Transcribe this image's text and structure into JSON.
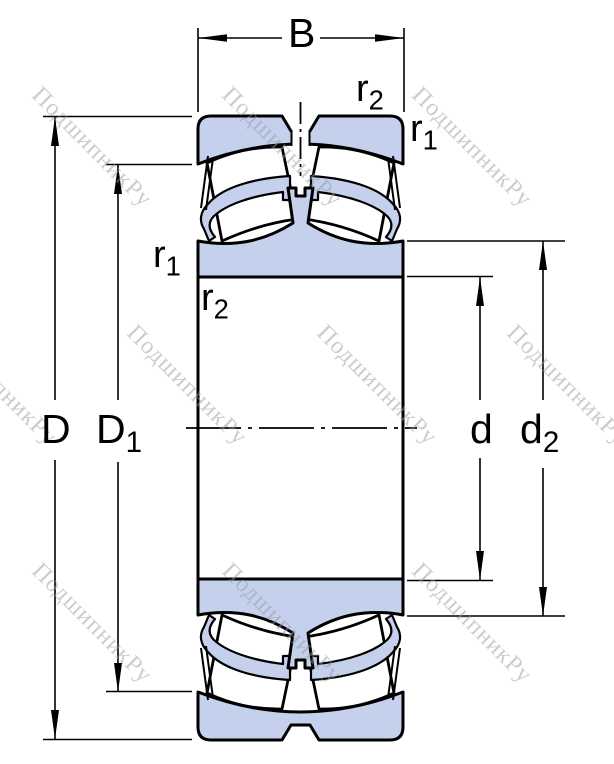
{
  "labels": {
    "width": {
      "base": "B"
    },
    "outer_diameter": {
      "base": "D"
    },
    "outer_recess_diameter": {
      "base": "D",
      "sub": "1"
    },
    "bore_diameter": {
      "base": "d"
    },
    "inner_recess_diameter": {
      "base": "d",
      "sub": "2"
    },
    "fillet_r1": {
      "base": "r",
      "sub": "1"
    },
    "fillet_r2": {
      "base": "r",
      "sub": "2"
    }
  },
  "watermark": {
    "text": "ПодшипникРу"
  },
  "colors": {
    "ring_fill": "#c5d1ec",
    "line": "#000000",
    "watermark": "rgba(148,153,164,0.5)"
  }
}
